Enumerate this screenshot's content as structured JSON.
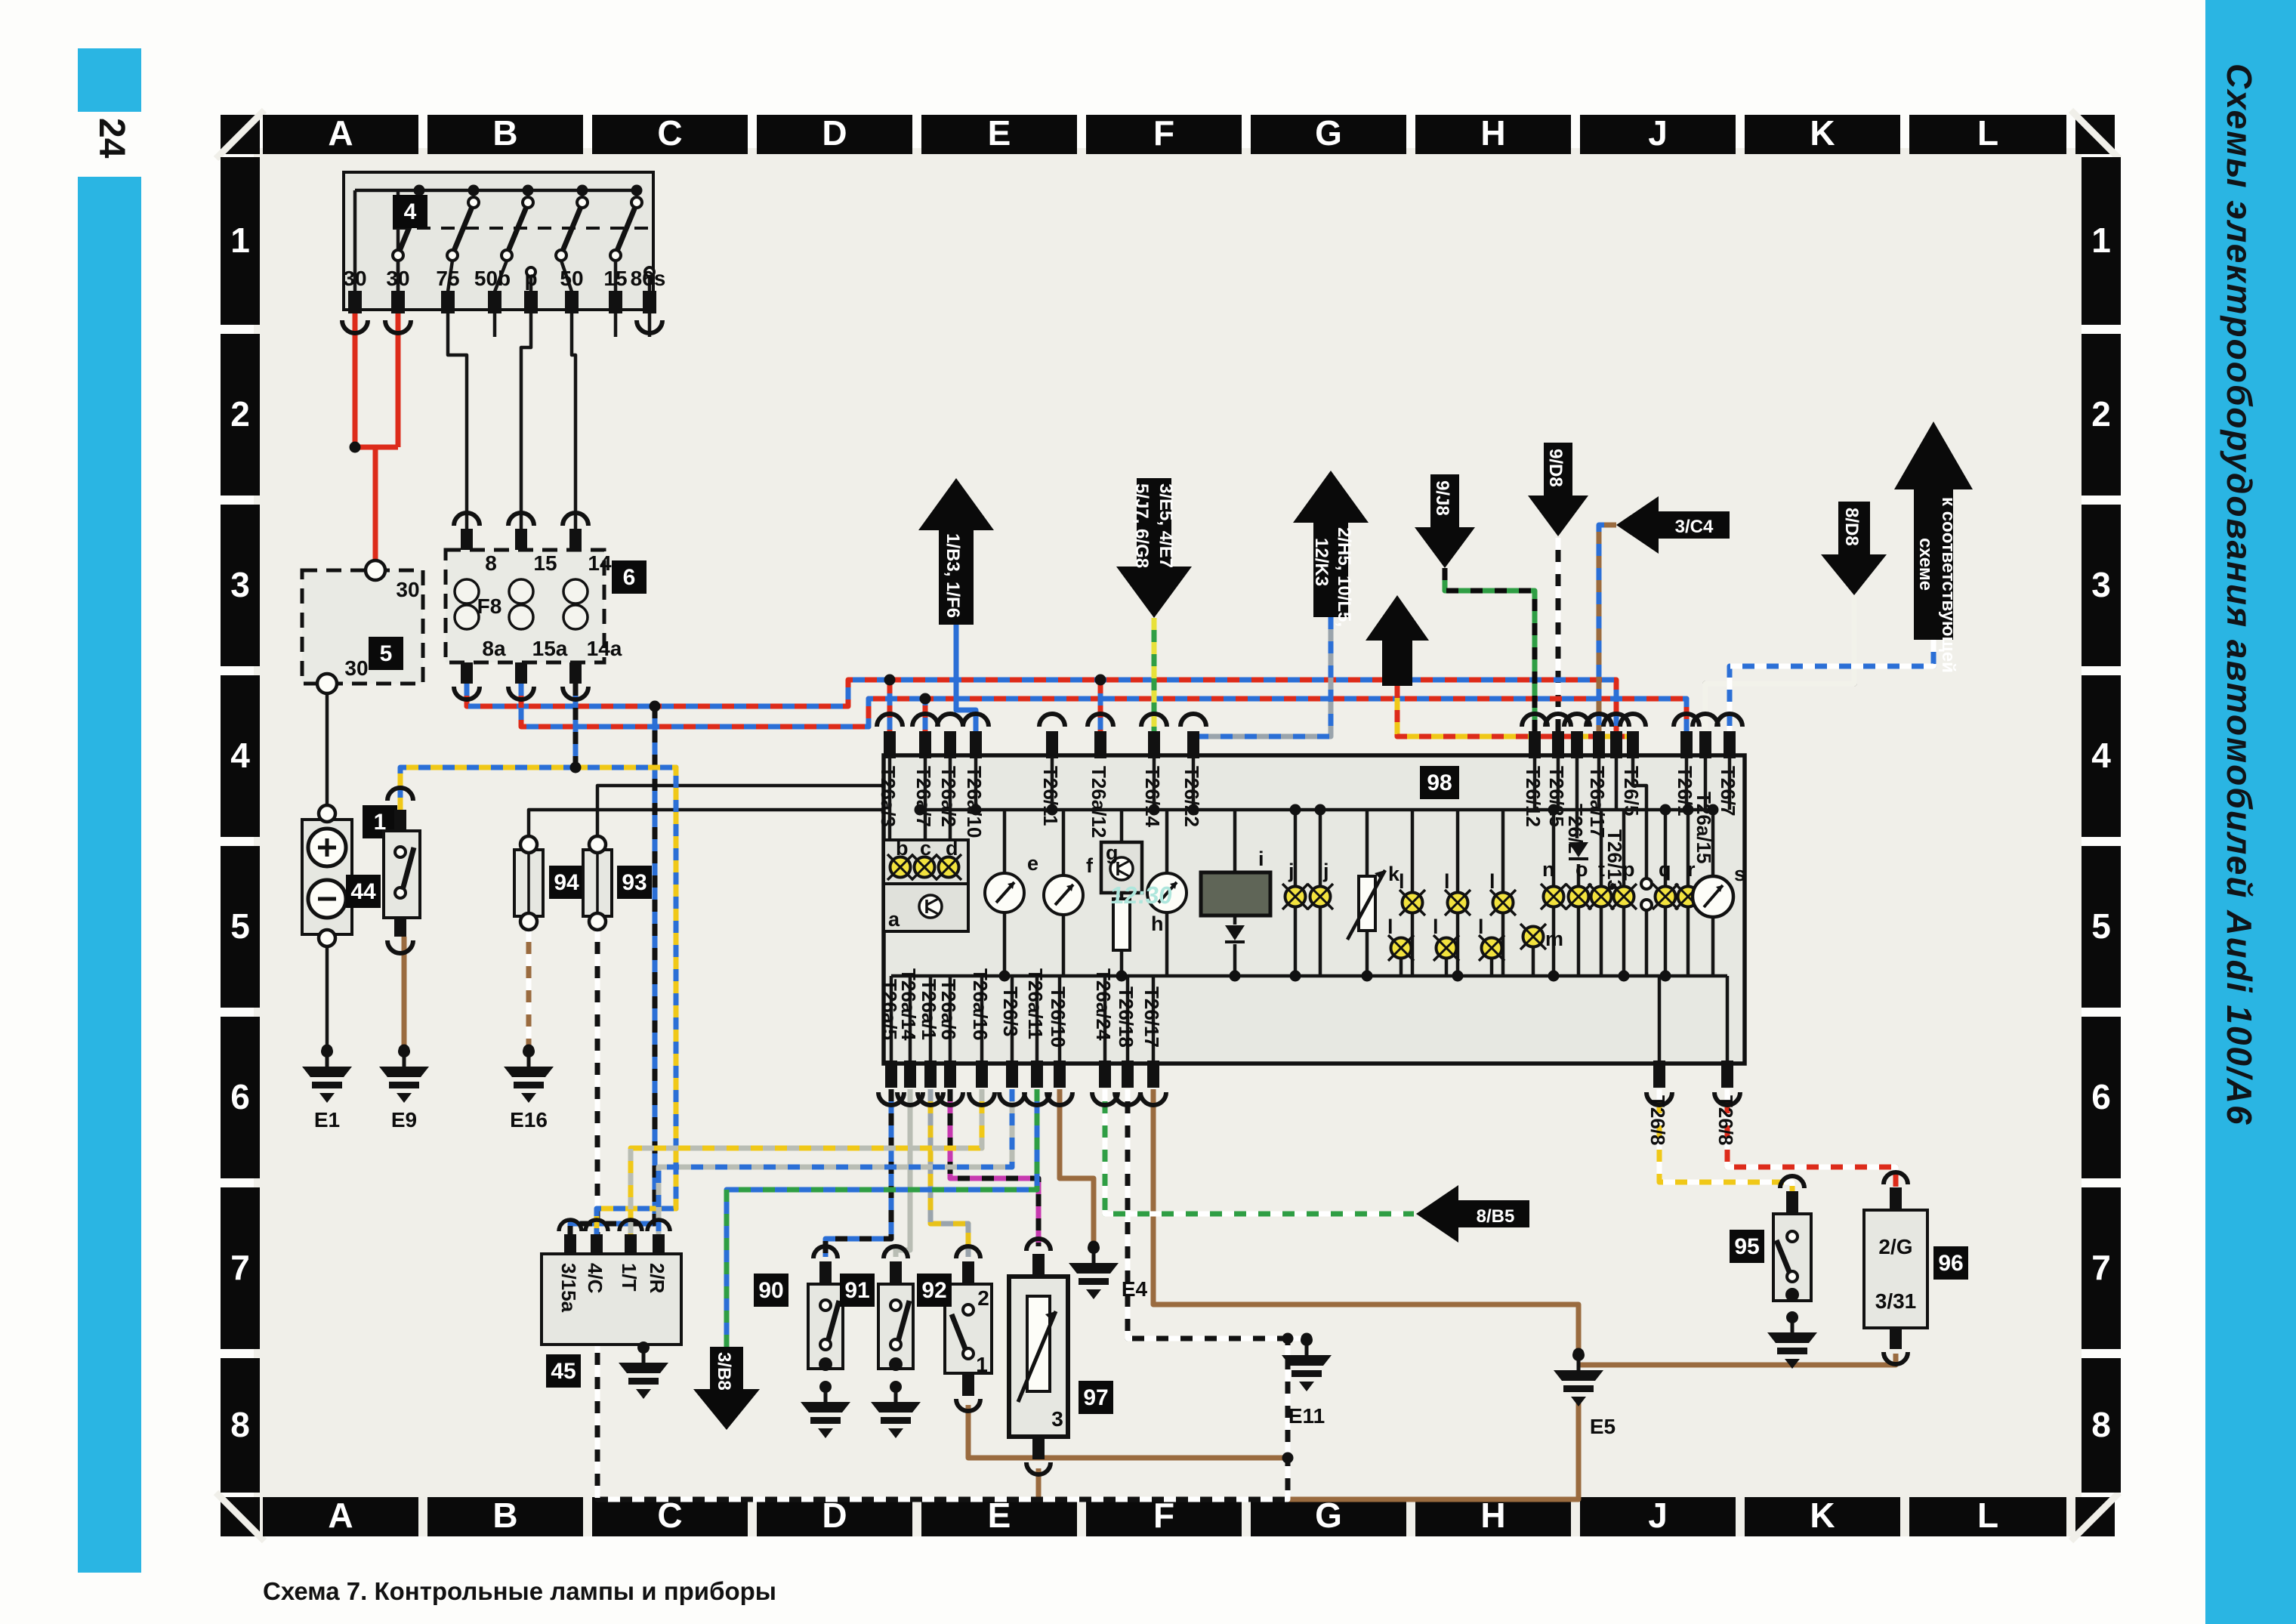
{
  "page": {
    "number": "24",
    "side_title": "Схемы электрооборудования автомобилей Audi 100/A6",
    "caption": "Схема 7. Контрольные лампы и приборы"
  },
  "grid": {
    "cols": [
      "A",
      "B",
      "C",
      "D",
      "E",
      "F",
      "G",
      "H",
      "J",
      "K",
      "L"
    ],
    "rows": [
      "1",
      "2",
      "3",
      "4",
      "5",
      "6",
      "7",
      "8"
    ]
  },
  "legend": {
    "c1": [
      "1. Аккумуляторная батарея",
      "4. Замок зажигания",
      "5. Монтажный блок реле",
      "6. Монтажный блок",
      "    предохранителей",
      "44. Датчик низкого уровня",
      "      охлаждающей жидкости",
      "45. Электронный",
      "      датчик температуры",
      "90. Выключатель контрольной",
      "      лампы низкого",
      "      давления масла (0,3 бар)",
      "91. Выключатель контрольной",
      "      лампы низкого",
      "      давления масла (1,8 бар)",
      "92. Датчик уровня тормозной",
      "      жидкости",
      "93. Датчик износа тормозных",
      "      накладок на правой стороне"
    ],
    "c2": [
      "94. Датчик износа тормозных",
      "      накладок на левой стороне",
      "95. Контрольная лампа",
      "      стояночного тормоза",
      "96. Датчик скорости автомобиля",
      "97. Датчик уровня топлива",
      "98. Комбинация приборов",
      "a=блок управления",
      "b=контрольная лампа износа",
      "    тормозных накладок",
      "c=контрольная лампа низкого",
      "    давления масла",
      "d=контрольная лампа температуры/",
      "    уровня охлаждающей жидкости"
    ],
    "c3": [
      "e=датчик температуры",
      "    охлаждающей жидкости",
      "f=датчик уровня топлива",
      "g=стабилизатор напряжения",
      "h=тахометр",
      "i=часы",
      "j=освещение часов",
      "k=реостат",
      "l=лампа освещения",
      "m=контрольная лампа правого",
      "      указателя поворота"
    ],
    "c4": [
      "n=контрольная лампа левого указателя",
      "    поворота",
      "o=контрольная лампа генератора",
      "p=контрольная лампа АБС",
      "q=контрольная лампа стояночного тормоза",
      "r=контрольная лампа дальнего света",
      "s=спидометр",
      "t=контрольная лампа свечей",
      "    накаливания"
    ]
  },
  "arrows": {
    "generator": {
      "caption": "Генератор",
      "label": "1/B3, 1/F6"
    },
    "tach": {
      "caption": "Тахометр",
      "l1": "3/E5, 4/E7",
      "l2": "5/J7, 6/G8"
    },
    "interior": {
      "caption": "Внутреннее\nосвещение",
      "l1": "2/H5, 10/L5,",
      "l2": "12/K3"
    },
    "abs": {
      "caption": "АБС"
    },
    "right_turn": {
      "caption": "Правый\nуказатель\nповорота",
      "label": "9/J8"
    },
    "left_turn": {
      "caption": "Левый\nуказатель\nповорота",
      "label": "9/D8"
    },
    "diesel_left": {
      "caption": "Система\nуправления\nдизельным\nдвигателем",
      "label": "3/C4"
    },
    "high_beam": {
      "caption": "Дальний\nсвет фар",
      "label": "8/D8"
    },
    "engine": {
      "caption": "Система\nуправления\nдвигателем",
      "l1": "к соответствующей",
      "l2": "схеме"
    },
    "b5": {
      "label": "8/B5"
    },
    "diesel_bottom": {
      "caption": "Система управления\nдизельным двигателем",
      "label": "3/B8"
    }
  },
  "components": {
    "battery": "1",
    "ignition": "4",
    "relay_block": "5",
    "fuse_block": "6",
    "fuse": "F8",
    "s44": "44",
    "s45": "45",
    "s90": "90",
    "s91": "91",
    "s92": "92",
    "s93": "93",
    "s94": "94",
    "s95": "95",
    "s96": "96",
    "s97": "97",
    "cluster": "98"
  },
  "ignition_terminals": [
    "30",
    "30",
    "75",
    "50b",
    "p",
    "50",
    "15",
    "86s"
  ],
  "fuse_top": [
    "8",
    "15",
    "14"
  ],
  "fuse_bottom": [
    "8a",
    "15a",
    "14a"
  ],
  "relay_terminals": [
    "30",
    "30"
  ],
  "s45_terminals": [
    "3/15a",
    "4/C",
    "1/T",
    "2/R"
  ],
  "s92_terminals": [
    "2",
    "1"
  ],
  "s97_terminal": "3",
  "s96_terminals": [
    "2/G",
    "3/31"
  ],
  "grounds": [
    "E1",
    "E9",
    "E16",
    "E4",
    "E11",
    "E5"
  ],
  "letters": {
    "a": "a",
    "b": "b",
    "c": "c",
    "d": "d",
    "e": "e",
    "f": "f",
    "g": "g",
    "h": "h",
    "i": "i",
    "j": "j",
    "k": "k",
    "l": "l",
    "m": "m",
    "n": "n",
    "o": "o",
    "p": "p",
    "q": "q",
    "r": "r",
    "s": "s",
    "t": "t"
  },
  "terminals": {
    "top": [
      "T26a/3",
      "T26a/7",
      "T26a/2",
      "T26a/10",
      "T26/11",
      "T26a/12",
      "T26/14",
      "T26/22",
      "T26/12",
      "T26/25",
      "T26/2",
      "T26a/17",
      "T26/13",
      "T26/5",
      "T26/1",
      "T26a/15",
      "T26/7"
    ],
    "bottom": [
      "T26a/5",
      "T26a/14",
      "T26a/1",
      "T26a/6",
      "T26a/16",
      "T26/3",
      "T26a/11",
      "T26/10",
      "T26a/24",
      "T26/18",
      "T26/17",
      "T26/8",
      "T26/8"
    ]
  },
  "clock": "12:30"
}
